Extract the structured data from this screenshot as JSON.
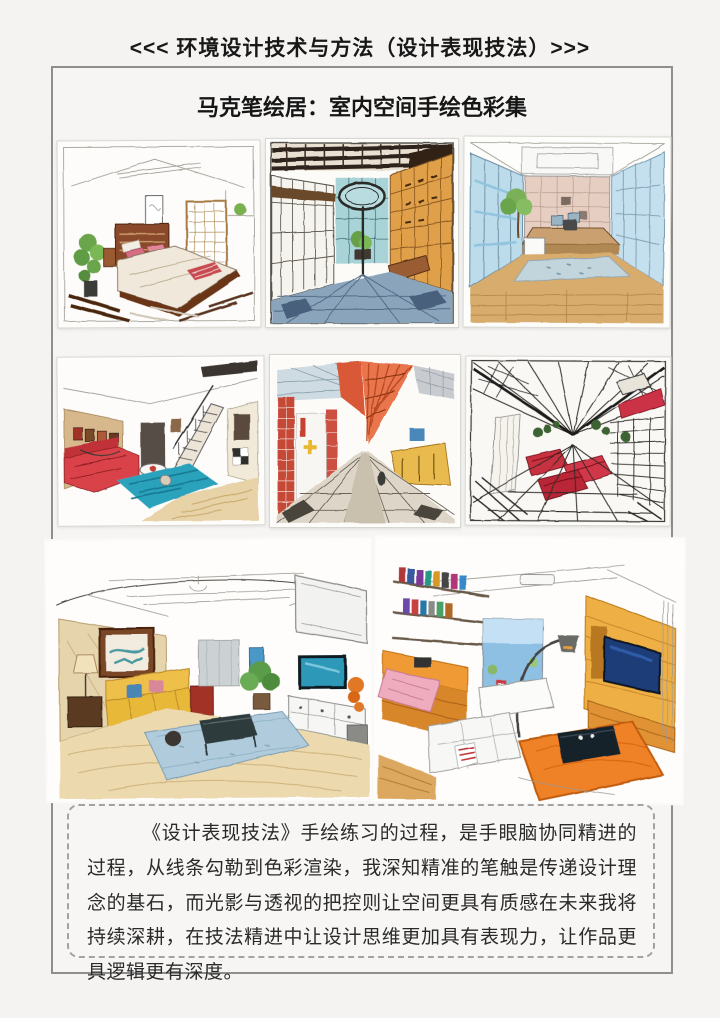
{
  "page": {
    "header": "<<< 环境设计技术与方法（设计表现技法）>>>",
    "subtitle": "马克笔绘居：室内空间手绘色彩集",
    "paragraph": "《设计表现技法》手绘练习的过程，是手眼脑协同精进的过程，从线条勾勒到色彩渲染，我深知精准的笔触是传递设计理念的基石，而光影与透视的把控则让空间更具有质感在未来我将持续深耕，在技法精进中让设计思维更加具有表现力，让作品更具逻辑更有深度。"
  },
  "gallery": {
    "items": [
      {
        "name": "japanese-bedroom-sketch"
      },
      {
        "name": "atrium-bookstore-sketch"
      },
      {
        "name": "glass-office-sketch"
      },
      {
        "name": "loft-living-room-sketch"
      },
      {
        "name": "red-beam-corridor-sketch"
      },
      {
        "name": "industrial-red-lounge-sketch"
      },
      {
        "name": "yellow-sofa-living-room-sketch"
      },
      {
        "name": "warm-orange-living-room-sketch"
      }
    ]
  },
  "palette": {
    "text": "#1f1f1f",
    "page_bg": "#f4f3f1",
    "frame_border": "#8e8e8e",
    "dashed_border": "#a2a2a2"
  }
}
